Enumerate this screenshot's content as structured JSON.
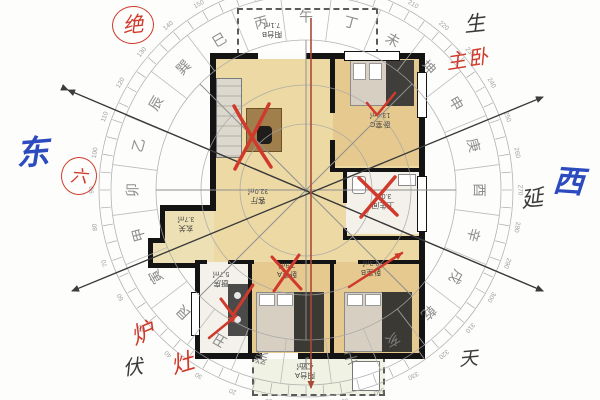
{
  "floorplan": {
    "rooms": [
      {
        "id": "balcony-top",
        "name": "阳台B",
        "area": "7.1㎡"
      },
      {
        "id": "bedroom-c",
        "name": "卧室C",
        "area": "13.4㎡"
      },
      {
        "id": "living-room",
        "name": "客厅",
        "area": "32.0㎡"
      },
      {
        "id": "bathroom",
        "name": "卫生间",
        "area": "3.0㎡"
      },
      {
        "id": "entry",
        "name": "玄关",
        "area": "3.7㎡"
      },
      {
        "id": "kitchen",
        "name": "厨房",
        "area": "5.7㎡"
      },
      {
        "id": "bedroom-a",
        "name": "卧室A",
        "area": "7.9㎡"
      },
      {
        "id": "bedroom-b",
        "name": "卧室B",
        "area": "9.3㎡"
      },
      {
        "id": "balcony-bottom",
        "name": "阳台A",
        "area": "4.5㎡"
      }
    ]
  },
  "compass": {
    "mountains": [
      "子",
      "癸",
      "丑",
      "艮",
      "寅",
      "甲",
      "卯",
      "乙",
      "辰",
      "巽",
      "巳",
      "丙",
      "午",
      "丁",
      "未",
      "坤",
      "申",
      "庚",
      "酉",
      "辛",
      "戌",
      "乾",
      "亥",
      "壬"
    ],
    "degree_labels": [
      "0",
      "10",
      "20",
      "30",
      "40",
      "50",
      "60",
      "70",
      "80",
      "90",
      "100",
      "110",
      "120",
      "130",
      "140",
      "150",
      "160",
      "170",
      "180",
      "190",
      "200",
      "210",
      "220",
      "230",
      "240",
      "250",
      "260",
      "270",
      "280",
      "290",
      "300",
      "310",
      "320",
      "330",
      "340",
      "350"
    ]
  },
  "annotations": {
    "jue": "绝",
    "sheng": "生",
    "zhuwo": "主卧",
    "dong": "东",
    "liu": "六",
    "yan": "延",
    "xi": "西",
    "fu": "伏",
    "lu": "炉",
    "zao": "灶",
    "tian": "天"
  },
  "colors": {
    "annotation_red": "#cf3a2c",
    "axis_line_red": "#a84a38",
    "annotation_blue": "#2b4bbf",
    "ink_black": "#3a3a3a",
    "wall_black": "#141414",
    "room_tan": "#e6c98e",
    "room_beige": "#ecd9a4",
    "room_white": "#f3f1ea",
    "balcony_green": "#edf1de",
    "compass_gray": "#8a8a8a"
  }
}
